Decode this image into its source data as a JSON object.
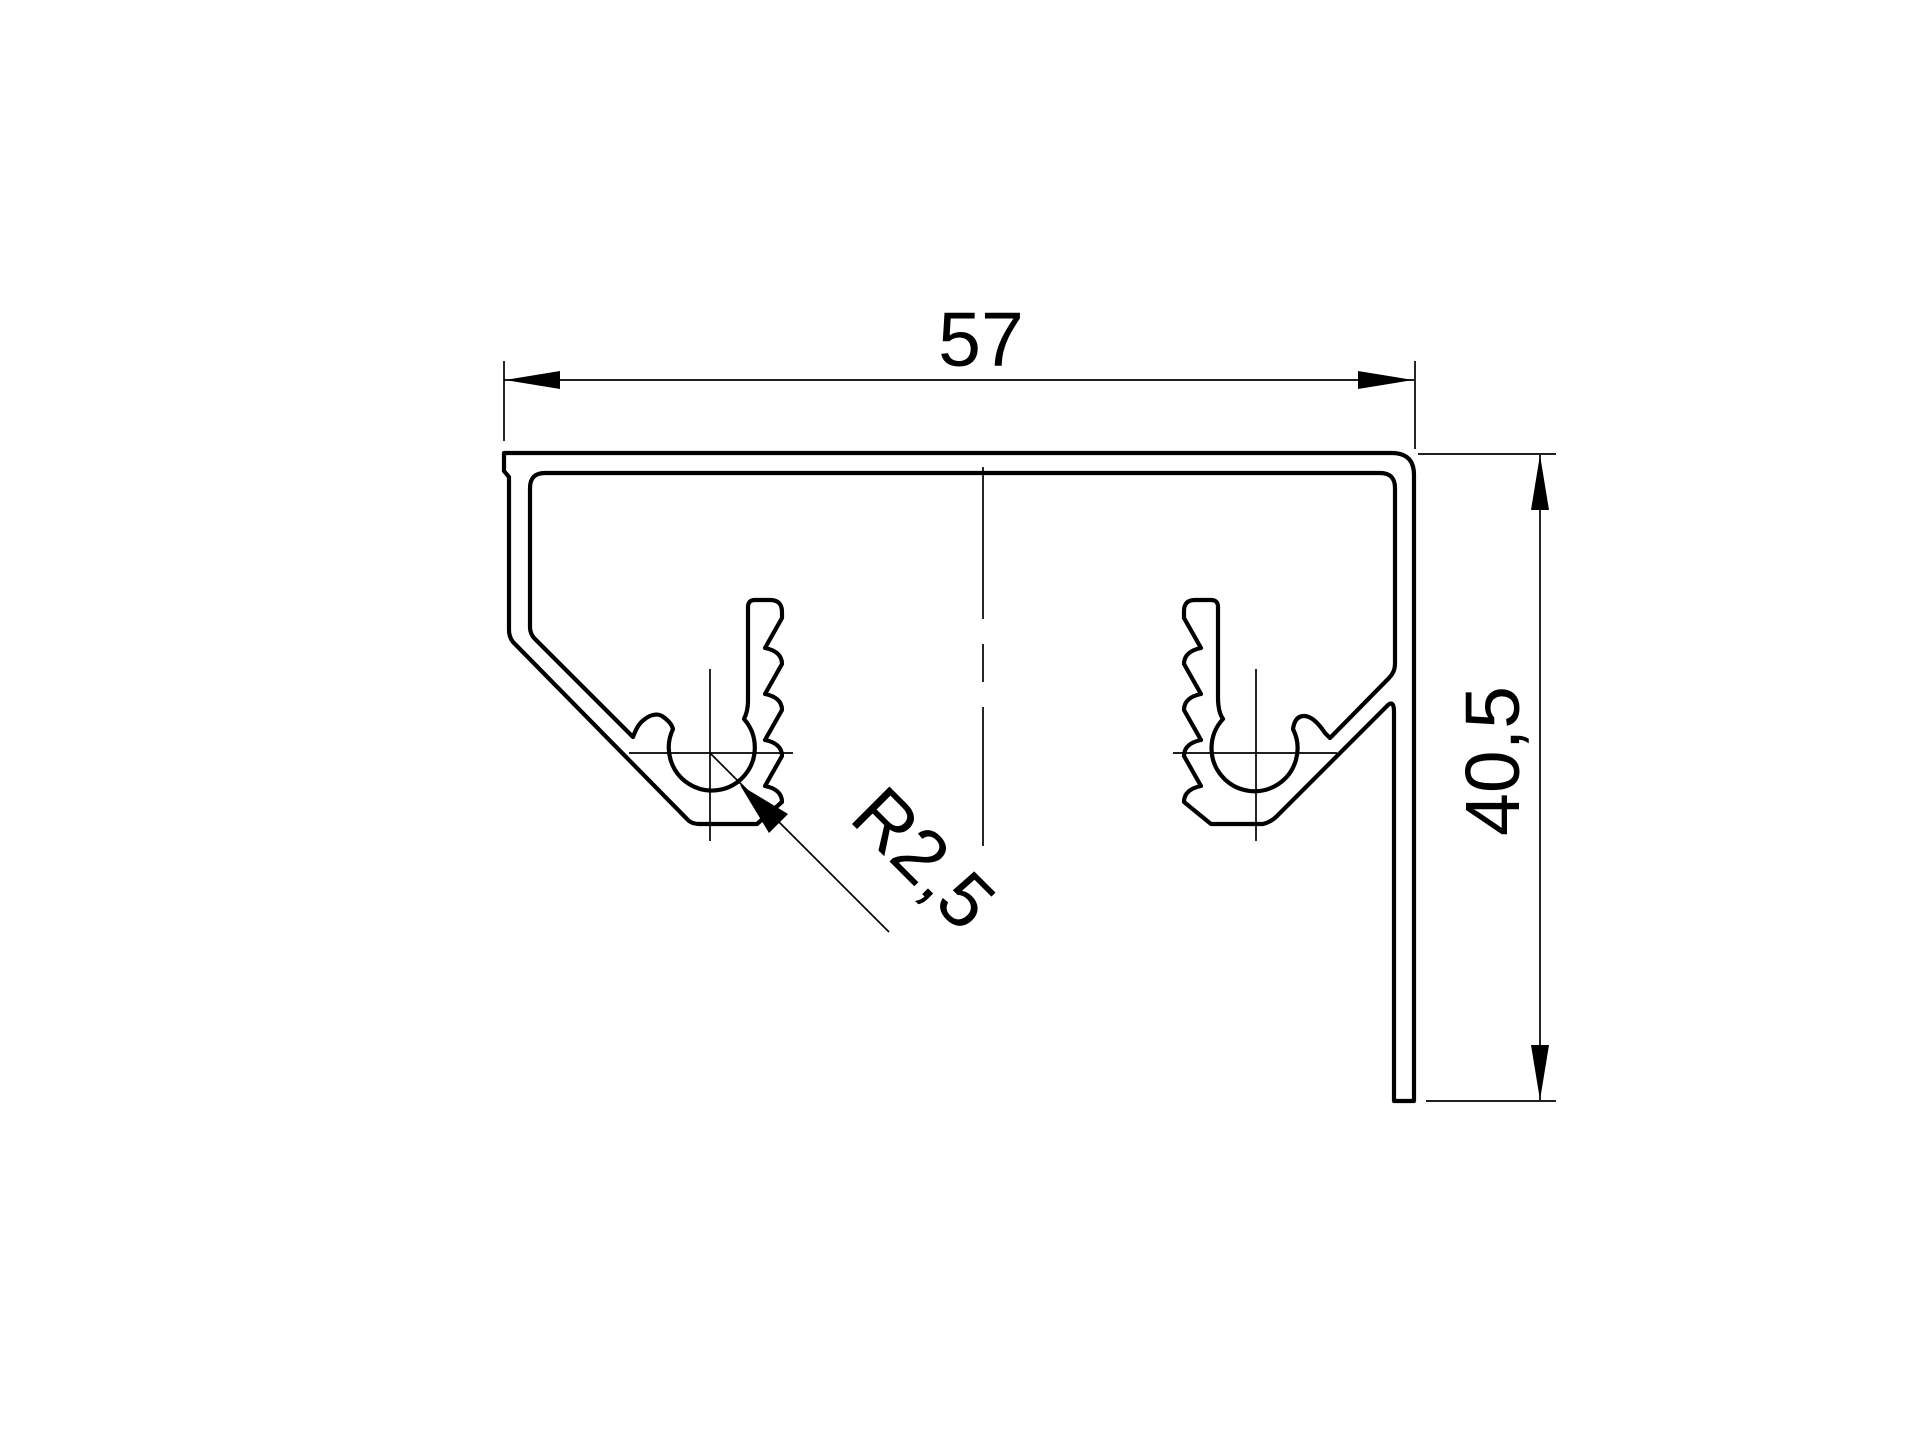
{
  "drawing": {
    "type": "technical-profile-cross-section",
    "description": "Dimensioned cross-section drawing of an extrusion profile with two serrated screw bosses",
    "units": "mm",
    "labels": {
      "width": "57",
      "height": "40,5",
      "radius": "R2,5"
    },
    "values": {
      "width_mm": 57,
      "height_mm": 40.5,
      "screw_port_radius_mm": 2.5
    },
    "colors": {
      "line": "#000000",
      "background": "#ffffff"
    }
  }
}
